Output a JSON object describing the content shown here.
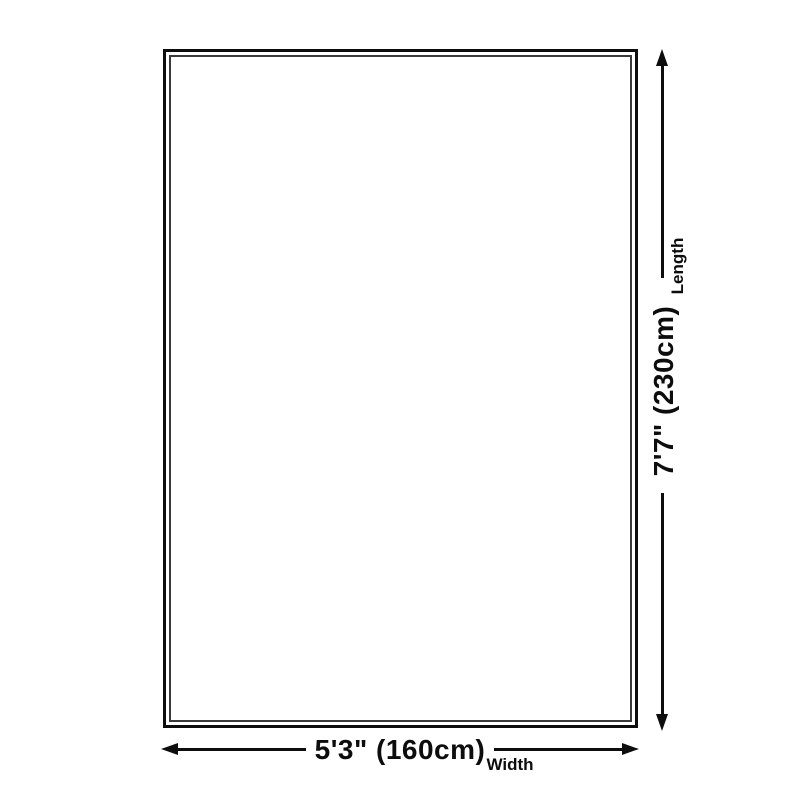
{
  "diagram": {
    "length_dimension": {
      "value": "7'7\" (230cm)",
      "label": "Length"
    },
    "width_dimension": {
      "value": "5'3\" (160cm)",
      "label": "Width"
    },
    "colors": {
      "background": "#ffffff",
      "line": "#0d0d0d"
    }
  }
}
